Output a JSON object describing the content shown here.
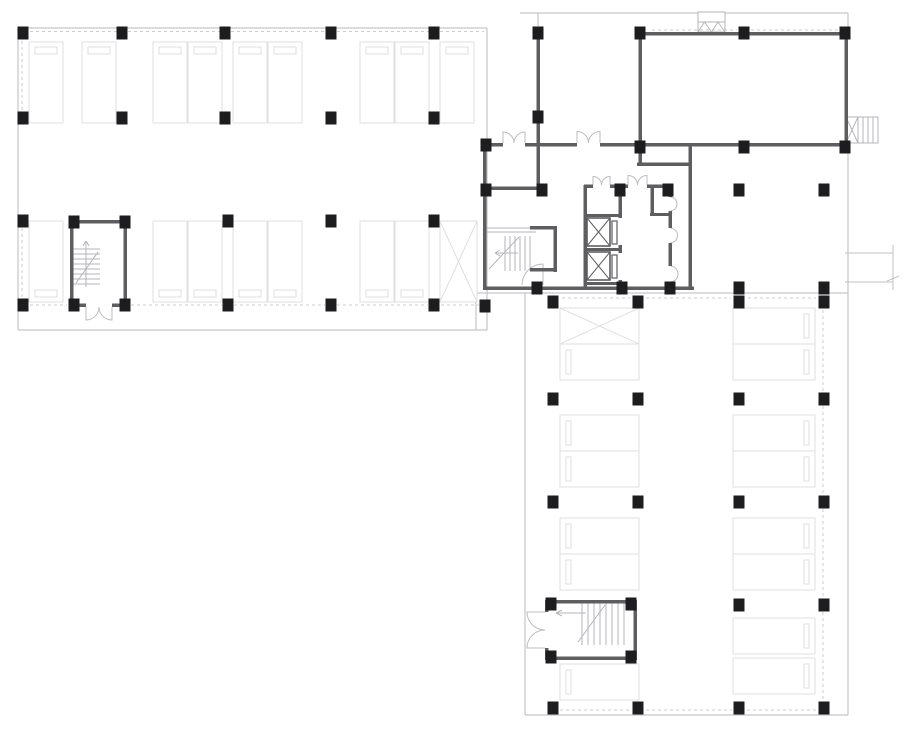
{
  "canvas": {
    "w": 910,
    "h": 731,
    "bg": "#ffffff"
  },
  "colors": {
    "wall": "#5e5e60",
    "column": "#1d1d1f",
    "boundary": "#c6c6c9",
    "dash": "#cdcdd0",
    "stall": "#dfdfe2",
    "door": "#bdbdc0",
    "stair": "#b6b6b9",
    "marker": "#c2c2c5",
    "bg": "#ffffff"
  },
  "column_size": [
    11,
    13
  ],
  "boundary_lines": [
    [
      18,
      28,
      487,
      28
    ],
    [
      18,
      28,
      18,
      330
    ],
    [
      18,
      330,
      487,
      330
    ],
    [
      487,
      28,
      487,
      330
    ],
    [
      476,
      293,
      848,
      293
    ],
    [
      525,
      293,
      525,
      715
    ],
    [
      525,
      715,
      848,
      715
    ],
    [
      848,
      146,
      848,
      715
    ],
    [
      476,
      293,
      476,
      330
    ],
    [
      520,
      13,
      698,
      13
    ],
    [
      725,
      13,
      848,
      13
    ],
    [
      538,
      13,
      538,
      30
    ],
    [
      848,
      13,
      848,
      32
    ]
  ],
  "dashed_lines": [
    [
      30,
      31.5,
      117,
      31.5
    ],
    [
      128,
      31.5,
      220,
      31.5
    ],
    [
      231,
      31.5,
      326,
      31.5
    ],
    [
      337,
      31.5,
      429,
      31.5
    ],
    [
      440,
      31.5,
      484,
      31.5
    ],
    [
      30,
      305,
      67,
      305
    ],
    [
      131,
      305,
      222,
      305
    ],
    [
      234,
      305,
      325,
      305
    ],
    [
      337,
      305,
      428,
      305
    ],
    [
      441,
      305,
      479,
      305
    ],
    [
      22,
      41,
      22,
      111
    ],
    [
      22,
      228,
      22,
      298
    ],
    [
      823,
      310,
      823,
      392
    ],
    [
      823,
      406,
      823,
      495
    ],
    [
      823,
      509,
      823,
      598
    ],
    [
      823,
      612,
      823,
      701
    ],
    [
      560,
      710,
      631,
      710
    ],
    [
      646,
      710,
      732,
      710
    ],
    [
      747,
      710,
      817,
      710
    ],
    [
      562,
      298,
      630,
      298
    ],
    [
      646,
      298,
      731,
      298
    ],
    [
      748,
      298,
      816,
      298
    ],
    [
      652,
      30,
      737,
      30
    ],
    [
      751,
      30,
      838,
      30
    ]
  ],
  "walls": [
    [
      483,
      143,
      3.5,
      147
    ],
    [
      483,
      143,
      20,
      3.5
    ],
    [
      525,
      143,
      52,
      3.5
    ],
    [
      600,
      143,
      40,
      3.5
    ],
    [
      640,
      143,
      208,
      3.5
    ],
    [
      483,
      286.5,
      211,
      3.5
    ],
    [
      536.5,
      30,
      3.5,
      160
    ],
    [
      483,
      186.5,
      62,
      3.5
    ],
    [
      638.5,
      30,
      3.5,
      133
    ],
    [
      637,
      162.5,
      55,
      3.5
    ],
    [
      688.5,
      146,
      3.5,
      144
    ],
    [
      637,
      32,
      211,
      3.5
    ],
    [
      844.5,
      32,
      3.5,
      114
    ],
    [
      584,
      184.5,
      9,
      3.5
    ],
    [
      610,
      184.5,
      18,
      3.5
    ],
    [
      647,
      184.5,
      23,
      3.5
    ],
    [
      583.5,
      185,
      3.5,
      105
    ],
    [
      618.5,
      185,
      3.5,
      33
    ],
    [
      618.5,
      245,
      3.5,
      8
    ],
    [
      618.5,
      280,
      3.5,
      10
    ],
    [
      584,
      214,
      36,
      3
    ],
    [
      584,
      248,
      36,
      3
    ],
    [
      584,
      282,
      36,
      3
    ],
    [
      650.5,
      185,
      3.5,
      31
    ],
    [
      650,
      213,
      20,
      3
    ],
    [
      668.5,
      185,
      3.5,
      12
    ],
    [
      668.5,
      211,
      3.5,
      17
    ],
    [
      668.5,
      243,
      3.5,
      23
    ],
    [
      668.5,
      282,
      3.5,
      8
    ],
    [
      530,
      226,
      27,
      3.5
    ],
    [
      553.5,
      226,
      3.5,
      46
    ],
    [
      530,
      268,
      27,
      3.5
    ],
    [
      70,
      220,
      57,
      3.5
    ],
    [
      70,
      220,
      3.5,
      87
    ],
    [
      123.5,
      220,
      3.5,
      87
    ],
    [
      70,
      303.5,
      16,
      3.5
    ],
    [
      112,
      303.5,
      15,
      3.5
    ],
    [
      545,
      600,
      92,
      3.5
    ],
    [
      633.5,
      600,
      3.5,
      60
    ],
    [
      545,
      656.5,
      92,
      3.5
    ],
    [
      545,
      600,
      3.5,
      12
    ],
    [
      545,
      648,
      3.5,
      12
    ]
  ],
  "columns": [
    [
      23,
      33
    ],
    [
      122,
      33
    ],
    [
      225,
      33
    ],
    [
      331,
      33
    ],
    [
      434,
      33
    ],
    [
      23,
      118
    ],
    [
      122,
      118
    ],
    [
      225,
      118
    ],
    [
      331,
      118
    ],
    [
      434,
      118
    ],
    [
      23,
      221
    ],
    [
      228,
      221
    ],
    [
      331,
      221
    ],
    [
      434,
      221
    ],
    [
      23,
      305
    ],
    [
      228,
      305
    ],
    [
      331,
      305
    ],
    [
      434,
      305
    ],
    [
      485,
      306
    ],
    [
      74,
      222
    ],
    [
      125,
      222
    ],
    [
      74,
      305
    ],
    [
      125,
      305
    ],
    [
      486,
      145
    ],
    [
      538,
      33
    ],
    [
      538,
      117
    ],
    [
      640,
      33
    ],
    [
      744,
      33
    ],
    [
      845,
      33
    ],
    [
      640,
      147
    ],
    [
      744,
      147
    ],
    [
      845,
      147
    ],
    [
      486,
      190
    ],
    [
      542,
      190
    ],
    [
      620,
      190
    ],
    [
      668,
      190
    ],
    [
      537,
      288
    ],
    [
      622,
      288
    ],
    [
      670,
      288
    ],
    [
      739,
      190
    ],
    [
      824,
      190
    ],
    [
      739,
      288
    ],
    [
      824,
      288
    ],
    [
      553,
      302
    ],
    [
      638,
      302
    ],
    [
      739,
      302
    ],
    [
      824,
      302
    ],
    [
      553,
      399
    ],
    [
      638,
      399
    ],
    [
      739,
      399
    ],
    [
      824,
      399
    ],
    [
      553,
      502
    ],
    [
      638,
      502
    ],
    [
      739,
      502
    ],
    [
      824,
      502
    ],
    [
      739,
      605
    ],
    [
      824,
      605
    ],
    [
      551,
      604
    ],
    [
      631,
      604
    ],
    [
      551,
      657
    ],
    [
      631,
      657
    ],
    [
      553,
      708
    ],
    [
      638,
      708
    ],
    [
      739,
      708
    ],
    [
      824,
      708
    ]
  ],
  "stalls": {
    "vertical": [
      {
        "x": 29,
        "y": 42,
        "w": 34,
        "h": 81,
        "stop": "top"
      },
      {
        "x": 82,
        "y": 42,
        "w": 34,
        "h": 81,
        "stop": "top"
      },
      {
        "x": 153,
        "y": 42,
        "w": 34,
        "h": 81,
        "stop": "top"
      },
      {
        "x": 188,
        "y": 42,
        "w": 34,
        "h": 81,
        "stop": "top"
      },
      {
        "x": 233,
        "y": 42,
        "w": 34,
        "h": 81,
        "stop": "top"
      },
      {
        "x": 268,
        "y": 42,
        "w": 34,
        "h": 81,
        "stop": "top"
      },
      {
        "x": 360,
        "y": 42,
        "w": 34,
        "h": 81,
        "stop": "top"
      },
      {
        "x": 395,
        "y": 42,
        "w": 34,
        "h": 81,
        "stop": "top"
      },
      {
        "x": 440,
        "y": 42,
        "w": 34,
        "h": 81,
        "stop": "top"
      },
      {
        "x": 29,
        "y": 221,
        "w": 34,
        "h": 81,
        "stop": "bottom"
      },
      {
        "x": 153,
        "y": 221,
        "w": 34,
        "h": 81,
        "stop": "bottom"
      },
      {
        "x": 188,
        "y": 221,
        "w": 34,
        "h": 81,
        "stop": "bottom"
      },
      {
        "x": 233,
        "y": 221,
        "w": 34,
        "h": 81,
        "stop": "bottom"
      },
      {
        "x": 268,
        "y": 221,
        "w": 34,
        "h": 81,
        "stop": "bottom"
      },
      {
        "x": 360,
        "y": 221,
        "w": 34,
        "h": 81,
        "stop": "bottom"
      },
      {
        "x": 395,
        "y": 221,
        "w": 34,
        "h": 81,
        "stop": "bottom"
      },
      {
        "x": 440,
        "y": 221,
        "w": 37,
        "h": 81,
        "cross": true
      }
    ],
    "horizontal": [
      {
        "x": 560,
        "y": 308,
        "w": 79,
        "h": 36,
        "cross": true
      },
      {
        "x": 560,
        "y": 344,
        "w": 79,
        "h": 36,
        "stop": "left"
      },
      {
        "x": 560,
        "y": 415,
        "w": 79,
        "h": 36,
        "stop": "left"
      },
      {
        "x": 560,
        "y": 451,
        "w": 79,
        "h": 36,
        "stop": "left"
      },
      {
        "x": 560,
        "y": 518,
        "w": 79,
        "h": 36,
        "stop": "left"
      },
      {
        "x": 560,
        "y": 554,
        "w": 79,
        "h": 36,
        "stop": "left"
      },
      {
        "x": 560,
        "y": 664,
        "w": 79,
        "h": 36,
        "stop": "left"
      },
      {
        "x": 733,
        "y": 308,
        "w": 82,
        "h": 36,
        "stop": "right"
      },
      {
        "x": 733,
        "y": 344,
        "w": 82,
        "h": 36,
        "stop": "right"
      },
      {
        "x": 733,
        "y": 415,
        "w": 82,
        "h": 36,
        "stop": "right"
      },
      {
        "x": 733,
        "y": 451,
        "w": 82,
        "h": 36,
        "stop": "right"
      },
      {
        "x": 733,
        "y": 518,
        "w": 82,
        "h": 36,
        "stop": "right"
      },
      {
        "x": 733,
        "y": 554,
        "w": 82,
        "h": 36,
        "stop": "right"
      },
      {
        "x": 733,
        "y": 618,
        "w": 82,
        "h": 36,
        "stop": "right"
      },
      {
        "x": 733,
        "y": 658,
        "w": 82,
        "h": 36,
        "stop": "right"
      }
    ]
  },
  "elevators": {
    "cabs": [
      [
        587,
        218,
        23,
        28
      ],
      [
        587,
        252,
        23,
        28
      ]
    ],
    "doors": [
      [
        612,
        221,
        5,
        23
      ],
      [
        612,
        255,
        5,
        23
      ]
    ]
  },
  "glyph_paths": [
    {
      "name": "double-door-swing",
      "c": "door",
      "d": "M503,143 V132 A11,11 0 0 1 514,143 M525,143 V132 A11,11 0 0 0 514,143"
    },
    {
      "name": "double-door-swing",
      "c": "door",
      "d": "M577,143 V131.5 A11.5,11.5 0 0 1 588.5,143 M600,143 V131.5 A11.5,11.5 0 0 0 588.5,143"
    },
    {
      "name": "double-door-swing",
      "c": "door",
      "d": "M593,185 V176.5 A8.5,8.5 0 0 1 601.5,185 M610,185 V176.5 A8.5,8.5 0 0 0 601.5,185"
    },
    {
      "name": "double-door-swing",
      "c": "door",
      "d": "M628,185 V175.5 A9.5,9.5 0 0 1 637.5,185 M647,185 V175.5 A9.5,9.5 0 0 0 637.5,185"
    },
    {
      "name": "door-swing",
      "c": "door",
      "d": "M543,285 V264 A21,21 0 0 0 522,285"
    },
    {
      "name": "double-door-swing",
      "c": "door",
      "d": "M86,307 V320 A13,13 0 0 0 99,307 M112,307 V320 A13,13 0 0 1 99,307"
    },
    {
      "name": "double-door-swing",
      "c": "door",
      "d": "M545,612 H527 A18,18 0 0 0 545,630 M545,648 H527 A18,18 0 0 1 545,630"
    },
    {
      "name": "shaft-vent-arcs",
      "c": "door",
      "d": "M670,197 A7,7 0 0 1 670,211 M670,228 A7.5,7.5 0 0 1 670,243 M670,266 A8,8 0 0 1 670,282"
    },
    {
      "name": "roof-vent-symbol",
      "c": "stair",
      "d": "M698,12 H725 V32 H698 Z M698,22 H725 M698,32 L704.5,22 L711.5,32 L718,22 L725,32"
    },
    {
      "name": "louver-symbol",
      "c": "stair",
      "d": "M846,117 H878 V143 H846 Z M858,117 V143 M846,117 L858,143 M846,143 L858,117 M863,117 V143 M868,117 V143 M873,117 V143"
    },
    {
      "name": "level-marker",
      "c": "marker",
      "d": "M845,253 H893 M845,282 H893 M893,245 V290 M887,281 L899,276"
    },
    {
      "name": "stair-glyph-left-wing",
      "c": "stair",
      "d": "M73,249 H100 M73,254 H100 M73,259 H100 M73,264 H100 M73,269 H100 M73,274 H100 M73,279 H100 M73,284 H100 M86,241 V287 M86,241 L83,246 M86,241 L89,246 M76,283 L98,252"
    },
    {
      "name": "stair-glyph-core",
      "c": "stair",
      "d": "M486,228 H536 M486,232 H536 M505,236 V271 M510,236 V271 M515,236 V271 M520,236 V271 M525,236 V271 M530,236 V271 M489,269 L519,237 M495,253 H518 M495,253 L500,250 M495,253 L500,256"
    },
    {
      "name": "stair-glyph-bottom",
      "c": "stair",
      "d": "M582,602 V645 M588,602 V645 M594,602 V645 M600,602 V645 M606,602 V645 M612,602 V645 M618,602 V645 M624,602 V645 M578,642 L605,605 M556,613 H586 M556,613 L562,610 M556,613 L562,616"
    }
  ]
}
